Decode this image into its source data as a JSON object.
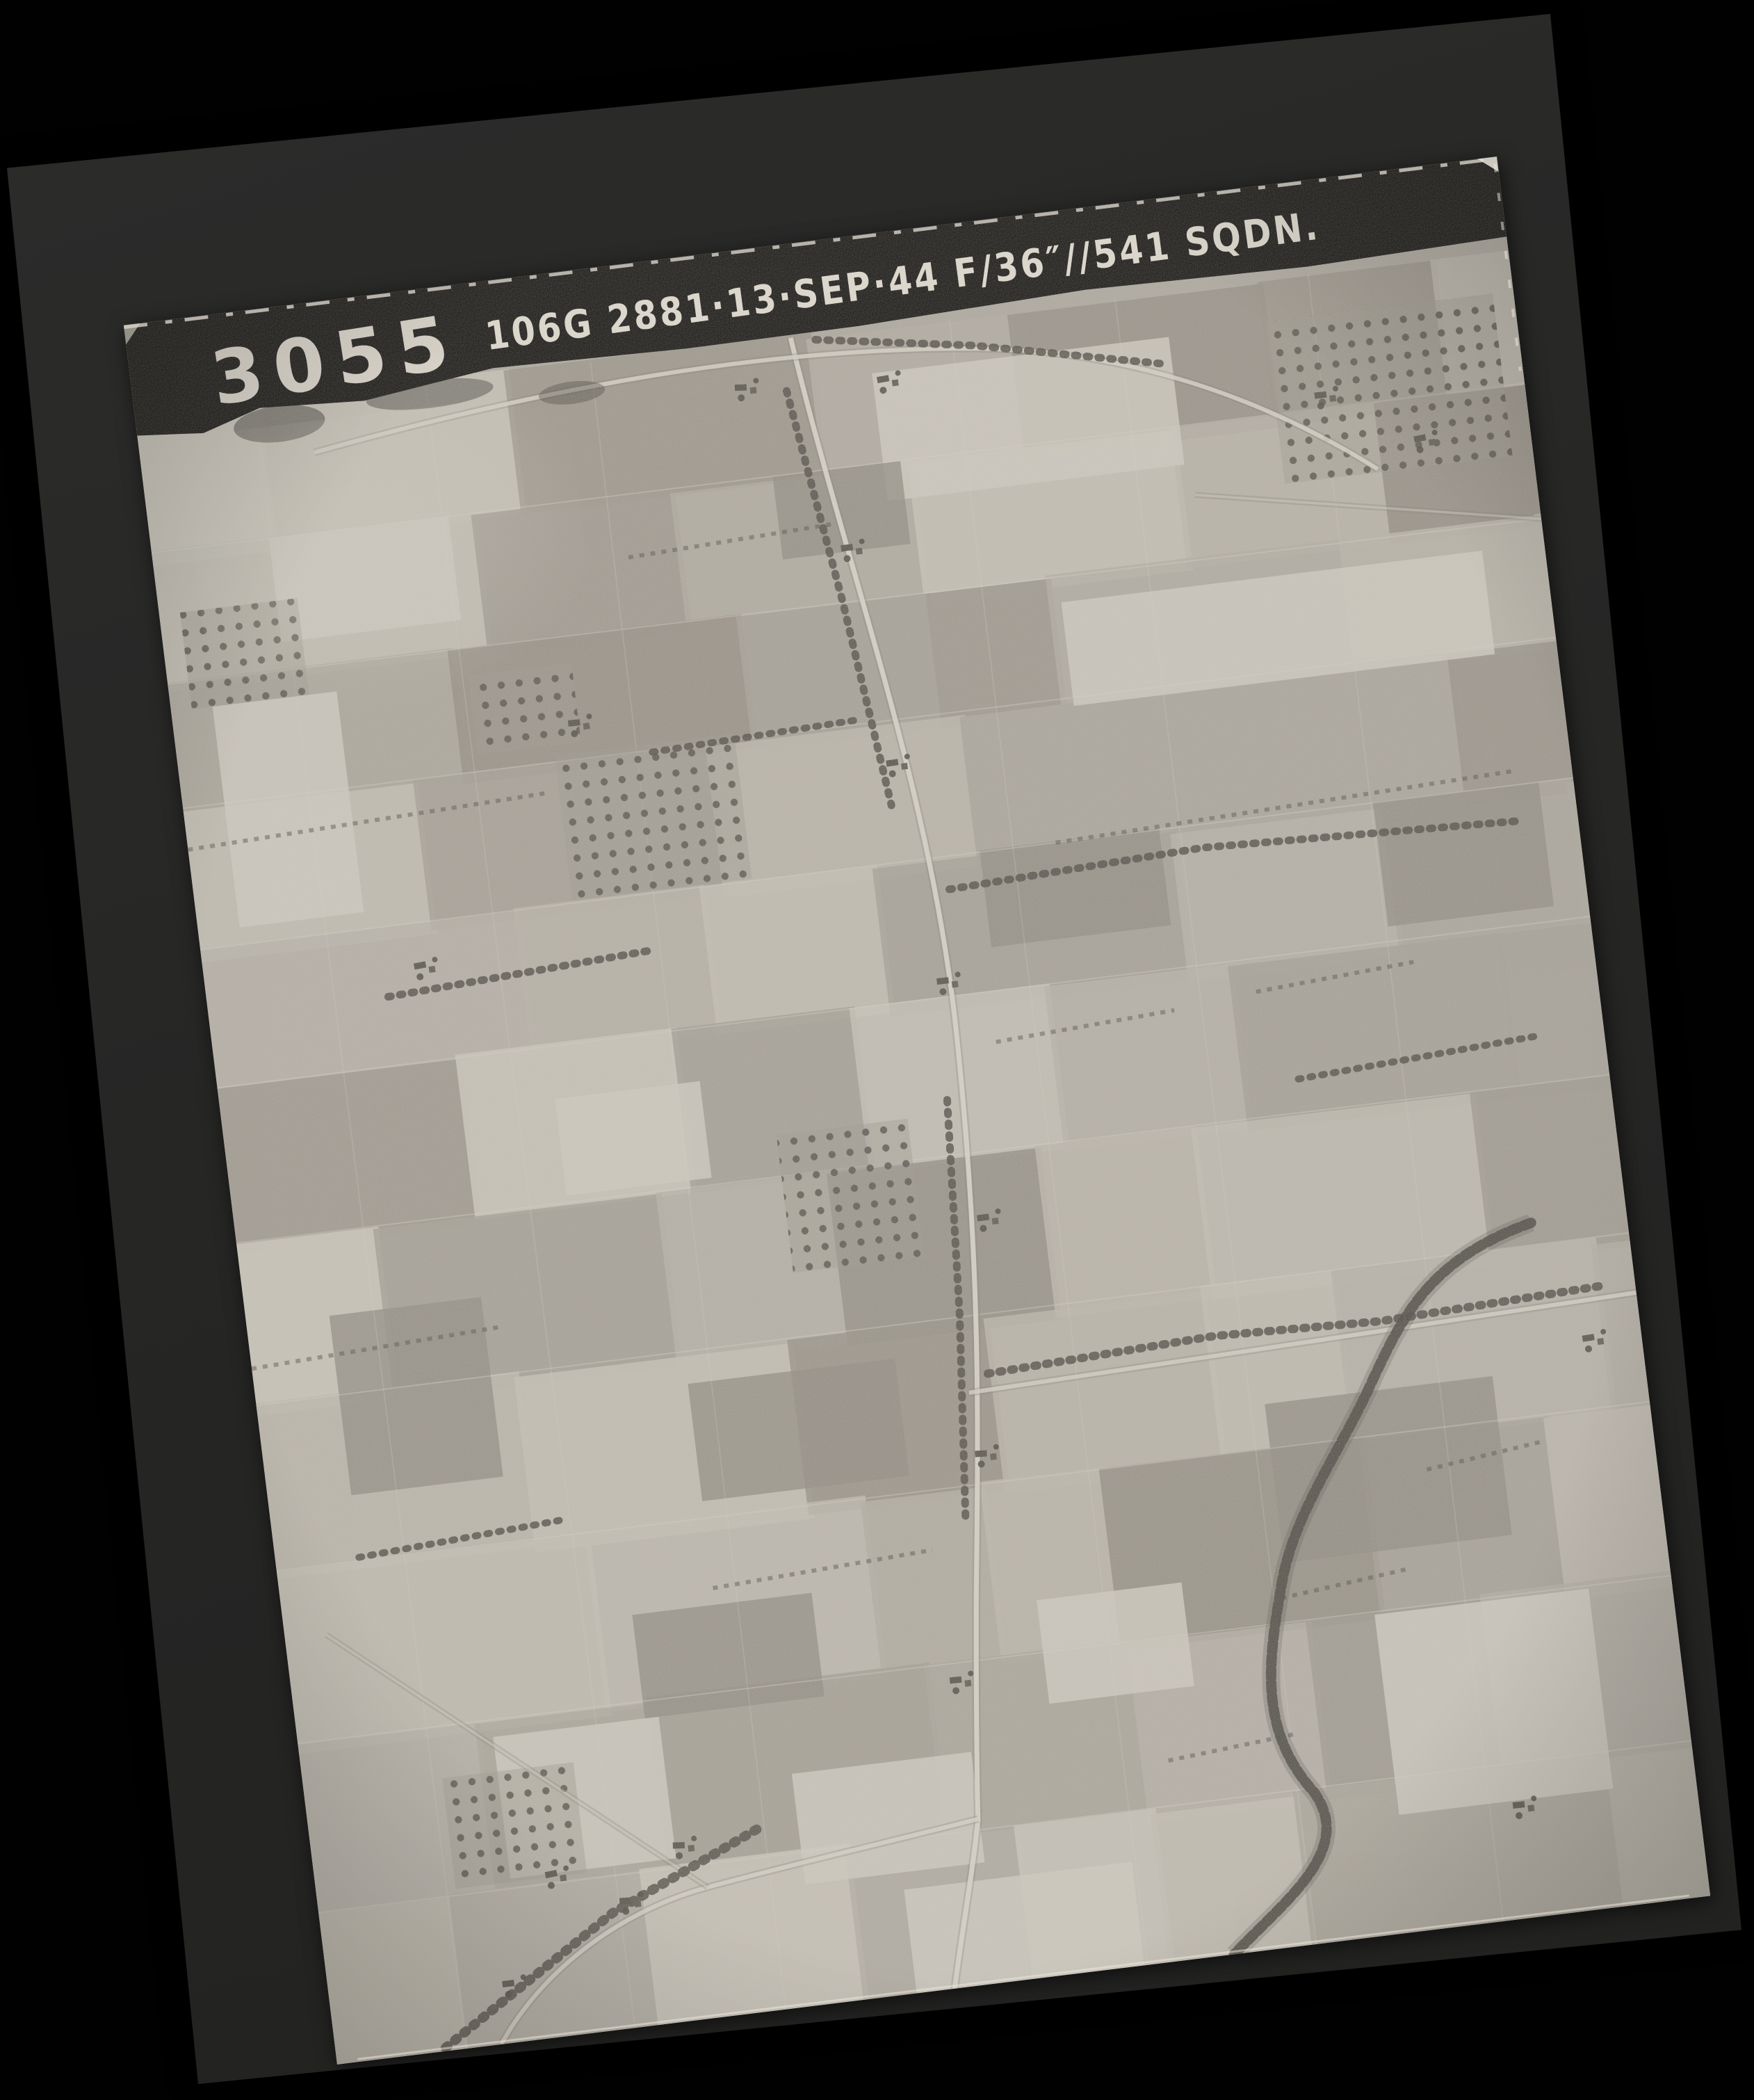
{
  "scan": {
    "background_color": "#010101"
  },
  "mount": {
    "color": "#262625"
  },
  "photo": {
    "frame_number": "3055",
    "annotation": "106G 2881·13·SEP·44  F/36″//541 SQDN.",
    "strip_color": "#0b0a08",
    "text_color": "#efe9dd",
    "base_tone": "#aca79d",
    "field_palette": [
      "#b6b1a7",
      "#a9a49a",
      "#c2beb3",
      "#9c978d",
      "#b0aba1",
      "#c8c4b9",
      "#a39e94",
      "#bbb6ab",
      "#958f85"
    ],
    "light_field": "#cecabf",
    "dark_field": "#8f8a80",
    "line_light": "#d5d1c6",
    "line_dark": "#7b776e",
    "tree": "#4a473f",
    "road": "#d9d5ca",
    "stream": "#45423b",
    "edge_white": "#eee9df"
  }
}
